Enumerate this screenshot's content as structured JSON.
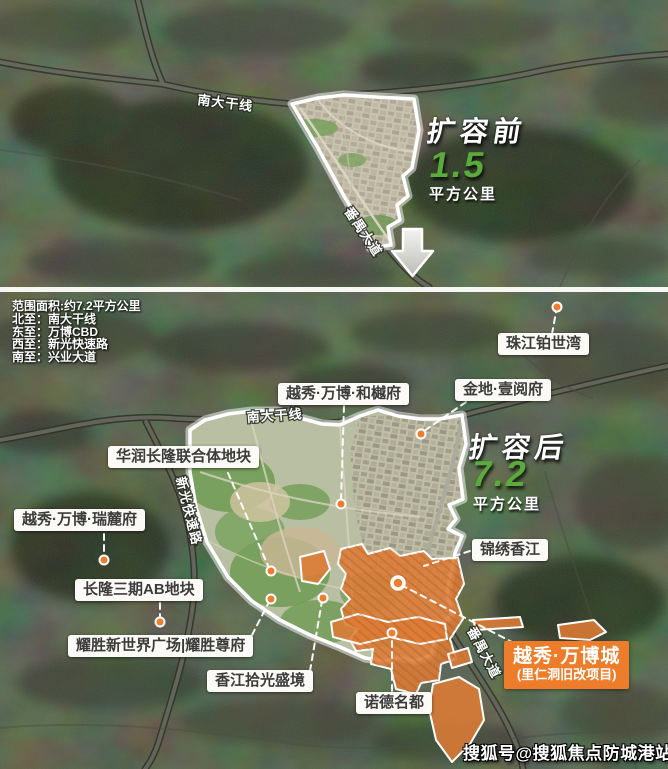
{
  "top_map": {
    "callout": {
      "title": "扩容前",
      "value": "1.5",
      "unit": "平方公里"
    },
    "road_labels": [
      {
        "text": "南大干线"
      },
      {
        "text": "番禺大道"
      }
    ]
  },
  "bottom_map": {
    "scope_info": {
      "area": "范围面积:约7.2平方公里",
      "north": "北至：南大干线",
      "east": "东至：万博CBD",
      "west": "西至：新光快速路",
      "south": "南至：兴业大道"
    },
    "callout": {
      "title": "扩容后",
      "value": "7.2",
      "unit": "平方公里"
    },
    "road_labels": [
      {
        "text": "南大干线"
      },
      {
        "text": "新光快速路"
      },
      {
        "text": "番禺大道"
      }
    ],
    "place_labels": [
      {
        "text": "珠江铂世湾"
      },
      {
        "text": "越秀·万博·和樾府"
      },
      {
        "text": "金地·壹阅府"
      },
      {
        "text": "华润长隆联合体地块"
      },
      {
        "text": "越秀·万博·瑞麓府"
      },
      {
        "text": "长隆三期AB地块"
      },
      {
        "text": "锦绣香江"
      },
      {
        "text": "耀胜新世界广场|耀胜尊府"
      },
      {
        "text": "香江拾光盛境"
      },
      {
        "text": "诺德名都"
      }
    ],
    "project_box": {
      "title": "越秀·万博城",
      "subtitle": "(里仁洞旧改项目)"
    }
  },
  "watermark": "搜狐号@搜狐焦点防城港站",
  "colors": {
    "accent_green": "#5aab3c",
    "accent_orange": "#ED7D2A",
    "overlay_orange": "#DD7B36",
    "label_bg": "#fbfaf6"
  }
}
